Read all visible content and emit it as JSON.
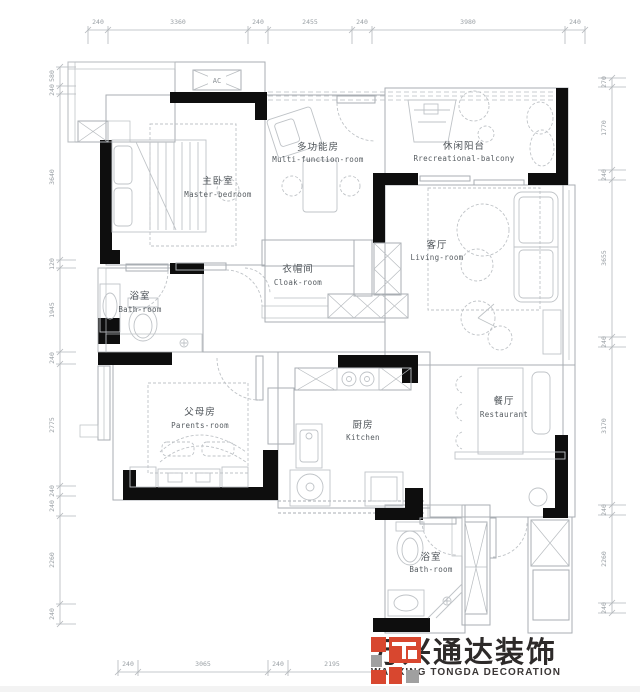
{
  "labels": {
    "ac": "AC"
  },
  "rooms": {
    "master": {
      "cn": "主卧室",
      "en": "Master-bedroom"
    },
    "multi": {
      "cn": "多功能房",
      "en": "Multi-function-room"
    },
    "balcony": {
      "cn": "休闲阳台",
      "en": "Rrecreational-balcony"
    },
    "living": {
      "cn": "客厅",
      "en": "Living-room"
    },
    "bath1": {
      "cn": "浴室",
      "en": "Bath-room"
    },
    "cloak": {
      "cn": "衣帽间",
      "en": "Cloak-room"
    },
    "parents": {
      "cn": "父母房",
      "en": "Parents-room"
    },
    "kitchen": {
      "cn": "厨房",
      "en": "Kitchen"
    },
    "restaurant": {
      "cn": "餐厅",
      "en": "Restaurant"
    },
    "bath2": {
      "cn": "浴室",
      "en": "Bath-room"
    }
  },
  "dims": {
    "top": [
      "240",
      "3360",
      "240",
      "2455",
      "240",
      "3980",
      "240"
    ],
    "bottom": [
      "240",
      "3065",
      "240",
      "2195"
    ],
    "left": [
      "580",
      "240",
      "3640",
      "120",
      "1945",
      "240",
      "2775",
      "240",
      "240",
      "2260",
      "240"
    ],
    "right": [
      "270",
      "1770",
      "240",
      "3655",
      "240",
      "3170",
      "240",
      "2260",
      "240"
    ]
  },
  "logo": {
    "cn": "万兴通达装饰",
    "en": "WANXING TONGDA DECORATION",
    "colors": {
      "red": "#d8472f",
      "gray": "#a0a0a0",
      "text": "#2d2a29"
    }
  }
}
